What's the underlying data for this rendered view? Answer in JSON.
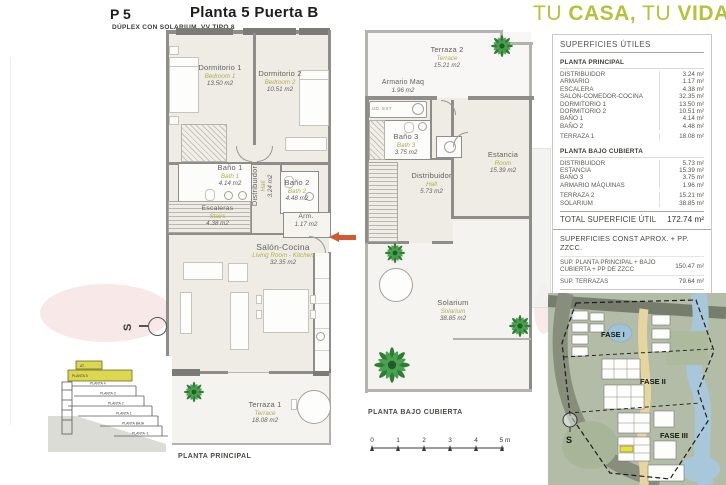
{
  "header": {
    "code": "P 5",
    "title": "Planta 5 Puerta B",
    "subtitle": "DÚPLEX CON SOLARIUM, VV TIPO 8"
  },
  "slogan": {
    "part1": "TU",
    "part2": "CASA,",
    "part3": "TU",
    "part4": "VIDA"
  },
  "plan1": {
    "caption": "PLANTA PRINCIPAL",
    "dorm1": {
      "name": "Dormitorio 1",
      "en": "Bedroom 1",
      "area": "13.50 m2"
    },
    "dorm2": {
      "name": "Dormitorio 2",
      "en": "Bedroom 2",
      "area": "10.51 m2"
    },
    "bano1": {
      "name": "Baño 1",
      "en": "Bath 1",
      "area": "4.14 m2"
    },
    "bano2": {
      "name": "Baño 2",
      "en": "Bath 2",
      "area": "4.48 m2"
    },
    "dist": {
      "name": "Distribuidor",
      "en": "Hall",
      "area": "3.24 m2"
    },
    "esc": {
      "name": "Escaleras",
      "en": "Stairs",
      "area": "4.38 m2"
    },
    "arm": {
      "name": "Arm.",
      "area": "1.17 m2"
    },
    "salon": {
      "name": "Salón-Cocina",
      "en": "Living Room - Kitchen",
      "area": "32.35 m2"
    },
    "terraza1": {
      "name": "Terraza 1",
      "en": "Terrace",
      "area": "18.08 m2"
    }
  },
  "plan2": {
    "caption": "PLANTA BAJO CUBIERTA",
    "terraza2": {
      "name": "Terraza 2",
      "en": "Terrace",
      "area": "15.21 m2"
    },
    "armmaq": {
      "name": "Armario Maq",
      "area": "1.96 m2"
    },
    "udext": "UD. EXT",
    "bano3": {
      "name": "Baño 3",
      "en": "Bath 3",
      "area": "3.75 m2"
    },
    "dist": {
      "name": "Distribuidor",
      "en": "Hall",
      "area": "5.73 m2"
    },
    "estancia": {
      "name": "Estancia",
      "en": "Room",
      "area": "15.39 m2"
    },
    "solarium": {
      "name": "Solarium",
      "en": "Solarium",
      "area": "38.85 m2"
    }
  },
  "area_table": {
    "title": "SUPERFICIES ÚTILES",
    "sections": [
      {
        "heading": "PLANTA PRINCIPAL",
        "rows": [
          {
            "label": "DISTRIBUIDOR",
            "value": "3.24 m²"
          },
          {
            "label": "ARMARIO",
            "value": "1.17 m²"
          },
          {
            "label": "ESCALERA",
            "value": "4.38 m²"
          },
          {
            "label": "SALON-COMEDOR-COCINA",
            "value": "32.35 m²"
          },
          {
            "label": "DORMITORIO 1",
            "value": "13.50 m²"
          },
          {
            "label": "DORMITORIO 2",
            "value": "10.51 m²"
          },
          {
            "label": "BAÑO 1",
            "value": "4.14 m²"
          },
          {
            "label": "BAÑO 2",
            "value": "4.48 m²"
          },
          {
            "label": "TERRAZA 1",
            "value": "18.08 m²"
          }
        ]
      },
      {
        "heading": "PLANTA BAJO CUBIERTA",
        "rows": [
          {
            "label": "DISTRIBUIDOR",
            "value": "5.73 m²"
          },
          {
            "label": "ESTANCIA",
            "value": "15.39 m²"
          },
          {
            "label": "BAÑO 3",
            "value": "3.75 m²"
          },
          {
            "label": "ARMARIO MÁQUINAS",
            "value": "1.96 m²"
          },
          {
            "label": "TERRAZA 2",
            "value": "15.21 m²"
          },
          {
            "label": "SOLARIUM",
            "value": "38.85 m²"
          }
        ]
      }
    ],
    "total": {
      "label": "TOTAL SUPERFICIE ÚTIL",
      "value": "172.74 m²"
    }
  },
  "const_table": {
    "title": "SUPERFICIES CONST APROX. + PP. ZZCC.",
    "rows": [
      {
        "label": "SUP. PLANTA PRINCIPAL + BAJO CUBIERTA + PP DE ZZCC",
        "value": "150.47 m²"
      },
      {
        "label": "SUP. TERRAZAS",
        "value": "79.64 m²"
      }
    ],
    "total": {
      "label": "TOTAL VIV. + TERRAZAS + ZZCC",
      "value": "230,11 m²"
    }
  },
  "scalebar": {
    "ticks": [
      "0",
      "1",
      "2",
      "3",
      "4",
      "5 m"
    ]
  },
  "compass": {
    "label": "S"
  },
  "sitemap": {
    "fase1": "FASE I",
    "fase2": "FASE II",
    "fase3": "FASE III",
    "south": "S"
  },
  "section_diagram": {
    "floors": [
      "AT.",
      "PLANTA 5",
      "PLANTA 4",
      "PLANTA 3",
      "PLANTA 2",
      "PLANTA 1",
      "PLANTA BAJA",
      "PLANTA -1"
    ]
  },
  "colors": {
    "brand_green": "#b6c23c",
    "label_green": "#b2ae4e",
    "arrow_orange": "#cf5b2e",
    "highlight_yellow": "#ddd64f",
    "wall_gray": "#8f8d89"
  }
}
